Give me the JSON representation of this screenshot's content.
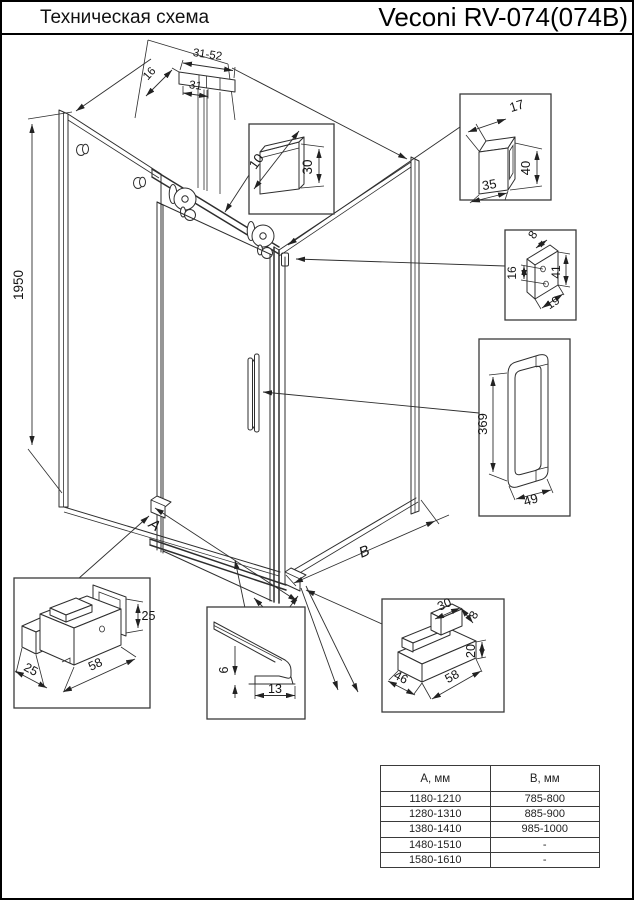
{
  "header": {
    "left_title": "Техническая схема",
    "right_title": "Veconi RV-074(074B)"
  },
  "dims": {
    "total_height": "1950",
    "width_label": "A",
    "depth_label": "B",
    "top_profile_range": "31-52",
    "top_profile_inner": "31",
    "top_profile_side": "16",
    "rail_width": "10",
    "rail_height": "30",
    "post_depth": "17",
    "post_height": "40",
    "post_width": "35",
    "bracket_thickness": "8",
    "bracket_hole_spacing": "16",
    "bracket_height": "41",
    "bracket_width": "19",
    "handle_length": "369",
    "handle_spacing": "49",
    "guide_height": "25",
    "guide_length": "58",
    "guide_depth": "25",
    "threshold_height": "6",
    "threshold_width": "13",
    "shoe_top": "30",
    "shoe_lip": "8",
    "shoe_height": "20",
    "shoe_depth": "46",
    "shoe_length": "58"
  },
  "table": {
    "headers": [
      "А, мм",
      "В, мм"
    ],
    "rows": [
      [
        "1180-1210",
        "785-800"
      ],
      [
        "1280-1310",
        "885-900"
      ],
      [
        "1380-1410",
        "985-1000"
      ],
      [
        "1480-1510",
        "-"
      ],
      [
        "1580-1610",
        "-"
      ]
    ]
  }
}
